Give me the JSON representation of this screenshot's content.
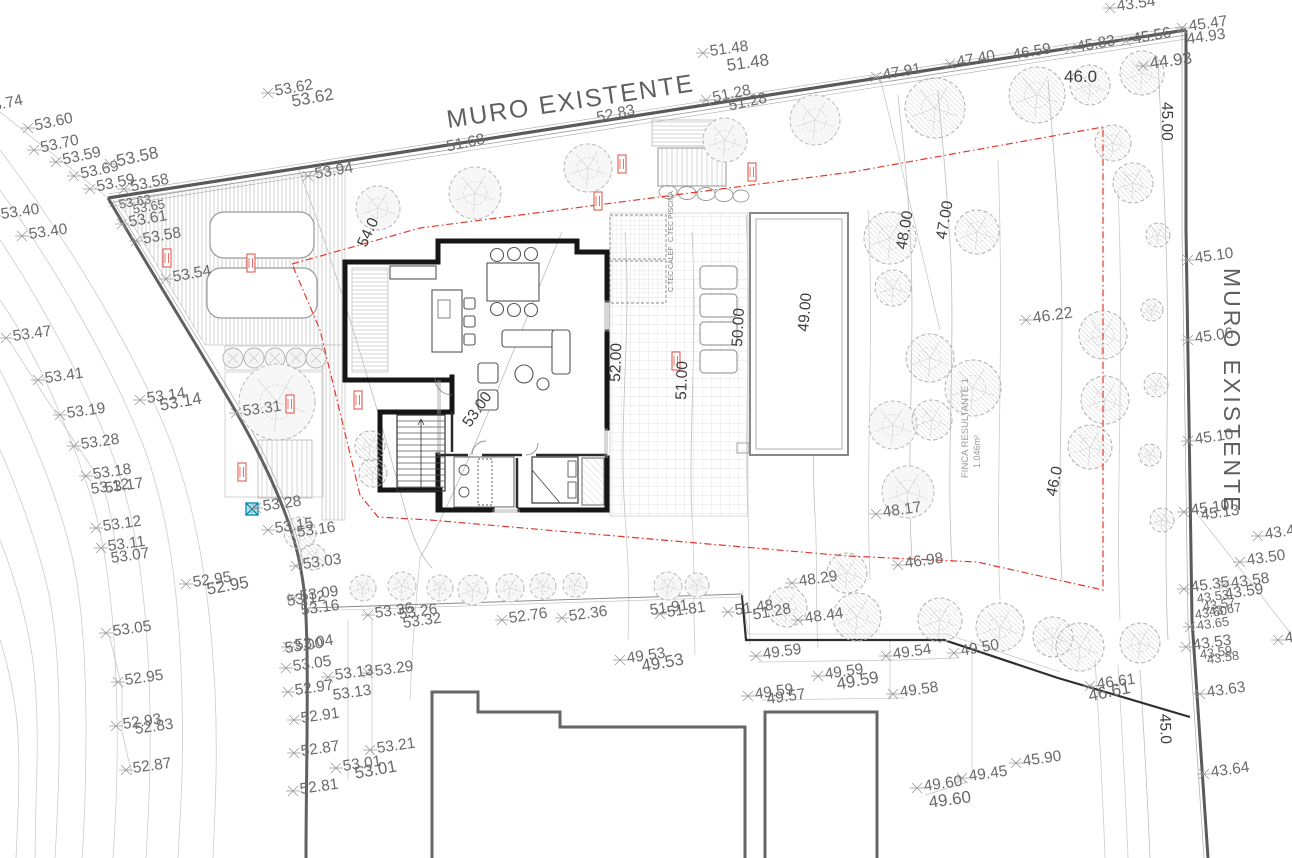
{
  "walls": {
    "top_label": "MURO EXISTENTE",
    "right_label": "MURO EXISTENTE"
  },
  "parcel": {
    "name": "FINCA RESULTANTE 1",
    "area": "1.046m²"
  },
  "rooms": {
    "pool_tech": "C.TEC PISCINA",
    "boiler": "C.TEC CALEF"
  },
  "colors": {
    "boundary_red": "#e0382c",
    "marker_cyan": "#3fb9d9",
    "wall_gray": "#5a5a5a",
    "label_gray": "#6a6a6a",
    "contour_label": "#3d3d3d"
  },
  "spot_elevations": [
    {
      "v": "53.74",
      "x": -22,
      "y": 110,
      "r": -12
    },
    {
      "v": "53.60",
      "x": 28,
      "y": 128,
      "r": -12
    },
    {
      "v": "53.70",
      "x": 34,
      "y": 150,
      "r": -12
    },
    {
      "v": "53.59",
      "x": 56,
      "y": 162,
      "r": -12
    },
    {
      "v": "53.69",
      "x": 74,
      "y": 176,
      "r": -12
    },
    {
      "v": "53.59",
      "x": 90,
      "y": 189,
      "r": -12
    },
    {
      "v": "53.58",
      "x": 110,
      "y": 164,
      "r": -12,
      "s": 17
    },
    {
      "v": "53.58",
      "x": 124,
      "y": 189,
      "r": -12
    },
    {
      "v": "53.40",
      "x": -6,
      "y": 216,
      "r": -8
    },
    {
      "v": "53.40",
      "x": 22,
      "y": 236,
      "r": -8
    },
    {
      "v": "53.63",
      "x": 112,
      "y": 206,
      "r": -10,
      "m": 0,
      "s": 13
    },
    {
      "v": "53.65",
      "x": 126,
      "y": 211,
      "r": -10,
      "m": 0,
      "s": 13
    },
    {
      "v": "53.61",
      "x": 122,
      "y": 224,
      "r": -10
    },
    {
      "v": "53.58",
      "x": 136,
      "y": 241,
      "r": -10
    },
    {
      "v": "53.54",
      "x": 166,
      "y": 279,
      "r": -10
    },
    {
      "v": "53.62",
      "x": 268,
      "y": 93,
      "r": -10
    },
    {
      "v": "53.62",
      "x": 285,
      "y": 104,
      "r": -10,
      "m": 0,
      "s": 17
    },
    {
      "v": "53.94",
      "x": 308,
      "y": 176,
      "r": -10
    },
    {
      "v": "51.48",
      "x": 703,
      "y": 53,
      "r": -8
    },
    {
      "v": "51.48",
      "x": 720,
      "y": 68,
      "r": -8,
      "m": 0,
      "s": 17
    },
    {
      "v": "51.28",
      "x": 706,
      "y": 100,
      "r": -12
    },
    {
      "v": "51.28",
      "x": 722,
      "y": 108,
      "r": -12,
      "m": 0
    },
    {
      "v": "51.68",
      "x": 440,
      "y": 149,
      "r": -12,
      "m": 0
    },
    {
      "v": "52.83",
      "x": 590,
      "y": 120,
      "r": -12,
      "m": 0
    },
    {
      "v": "47.91",
      "x": 876,
      "y": 77,
      "r": -10
    },
    {
      "v": "47.40",
      "x": 950,
      "y": 64,
      "r": -10
    },
    {
      "v": "46.59",
      "x": 1006,
      "y": 57,
      "r": -10,
      "m": 0
    },
    {
      "v": "45.83",
      "x": 1070,
      "y": 49,
      "r": -10
    },
    {
      "v": "45.56",
      "x": 1126,
      "y": 41,
      "r": -10
    },
    {
      "v": "44.93",
      "x": 1143,
      "y": 66,
      "r": -8,
      "s": 17
    },
    {
      "v": "43.54",
      "x": 1110,
      "y": 8,
      "r": -8
    },
    {
      "v": "45.47",
      "x": 1182,
      "y": 28,
      "r": -8
    },
    {
      "v": "44.93",
      "x": 1180,
      "y": 41,
      "r": -8,
      "m": 0
    },
    {
      "v": "45.10",
      "x": 1188,
      "y": 260,
      "r": -8
    },
    {
      "v": "45.06",
      "x": 1188,
      "y": 340,
      "r": -8
    },
    {
      "v": "45.10",
      "x": 1188,
      "y": 441,
      "r": -8
    },
    {
      "v": "45.10",
      "x": 1184,
      "y": 512,
      "r": -8
    },
    {
      "v": "45.13",
      "x": 1194,
      "y": 517,
      "r": -8,
      "m": 0
    },
    {
      "v": "43.47",
      "x": 1258,
      "y": 536,
      "r": -8
    },
    {
      "v": "43.50",
      "x": 1240,
      "y": 562,
      "r": -8
    },
    {
      "v": "43.58",
      "x": 1224,
      "y": 585,
      "r": -8
    },
    {
      "v": "43.59",
      "x": 1218,
      "y": 596,
      "r": -8,
      "m": 0
    },
    {
      "v": "45.35",
      "x": 1184,
      "y": 589,
      "r": -8
    },
    {
      "v": "43.53",
      "x": 1190,
      "y": 600,
      "r": -8,
      "m": 0,
      "s": 13
    },
    {
      "v": "43.57",
      "x": 1196,
      "y": 608,
      "r": -8,
      "m": 0,
      "s": 13
    },
    {
      "v": "43.60",
      "x": 1188,
      "y": 616,
      "r": -8,
      "m": 0,
      "s": 13
    },
    {
      "v": "43.67",
      "x": 1202,
      "y": 613,
      "r": -8,
      "m": 0,
      "s": 13
    },
    {
      "v": "43.65",
      "x": 1190,
      "y": 627,
      "r": -8,
      "s": 13
    },
    {
      "v": "43.53",
      "x": 1186,
      "y": 647,
      "r": -8
    },
    {
      "v": "43.59",
      "x": 1193,
      "y": 656,
      "r": -8,
      "m": 0,
      "s": 13
    },
    {
      "v": "43.58",
      "x": 1200,
      "y": 661,
      "r": -8,
      "m": 0,
      "s": 13
    },
    {
      "v": "43.63",
      "x": 1200,
      "y": 694,
      "r": -8
    },
    {
      "v": "43.64",
      "x": 1204,
      "y": 774,
      "r": -8
    },
    {
      "v": "43.65",
      "x": 1278,
      "y": 640,
      "r": -8
    },
    {
      "v": "46.61",
      "x": 1090,
      "y": 686,
      "r": -8
    },
    {
      "v": "46.61",
      "x": 1082,
      "y": 699,
      "r": -12,
      "m": 0,
      "s": 17
    },
    {
      "v": "45.90",
      "x": 1016,
      "y": 763,
      "r": -8
    },
    {
      "v": "49.45",
      "x": 962,
      "y": 778,
      "r": -8
    },
    {
      "v": "49.60",
      "x": 917,
      "y": 788,
      "r": -8
    },
    {
      "v": "49.60",
      "x": 922,
      "y": 805,
      "r": -8,
      "m": 0,
      "s": 17
    },
    {
      "v": "49.59",
      "x": 756,
      "y": 656,
      "r": -8
    },
    {
      "v": "49.54",
      "x": 886,
      "y": 656,
      "r": -8
    },
    {
      "v": "49.50",
      "x": 954,
      "y": 653,
      "r": -10
    },
    {
      "v": "49.59",
      "x": 818,
      "y": 676,
      "r": -8
    },
    {
      "v": "49.59",
      "x": 830,
      "y": 687,
      "r": -10,
      "m": 0,
      "s": 17
    },
    {
      "v": "49.59",
      "x": 748,
      "y": 696,
      "r": -8
    },
    {
      "v": "49.57",
      "x": 760,
      "y": 701,
      "r": -8,
      "m": 0
    },
    {
      "v": "49.58",
      "x": 893,
      "y": 694,
      "r": -8
    },
    {
      "v": "49.53",
      "x": 620,
      "y": 660,
      "r": -8
    },
    {
      "v": "49.53",
      "x": 635,
      "y": 669,
      "r": -10,
      "m": 0,
      "s": 17
    },
    {
      "v": "48.44",
      "x": 798,
      "y": 620,
      "r": -8
    },
    {
      "v": "51.28",
      "x": 746,
      "y": 617,
      "r": -10,
      "m": 0
    },
    {
      "v": "51.48",
      "x": 728,
      "y": 612,
      "r": -8
    },
    {
      "v": "48.29",
      "x": 792,
      "y": 583,
      "r": -8
    },
    {
      "v": "46.98",
      "x": 898,
      "y": 565,
      "r": -8
    },
    {
      "v": "48.17",
      "x": 876,
      "y": 514,
      "r": -8
    },
    {
      "v": "51.81",
      "x": 660,
      "y": 614,
      "r": -8
    },
    {
      "v": "51.91",
      "x": 643,
      "y": 612,
      "r": -8,
      "m": 0
    },
    {
      "v": "52.36",
      "x": 562,
      "y": 618,
      "r": -8
    },
    {
      "v": "52.76",
      "x": 502,
      "y": 620,
      "r": -8
    },
    {
      "v": "53.36",
      "x": 368,
      "y": 615,
      "r": -8
    },
    {
      "v": "53.26",
      "x": 392,
      "y": 616,
      "r": -8,
      "m": 0
    },
    {
      "v": "53.32",
      "x": 396,
      "y": 625,
      "r": -8,
      "m": 0
    },
    {
      "v": "53.29",
      "x": 368,
      "y": 673,
      "r": -8
    },
    {
      "v": "53.13",
      "x": 328,
      "y": 677,
      "r": -8
    },
    {
      "v": "53.13",
      "x": 326,
      "y": 697,
      "r": -8,
      "m": 0
    },
    {
      "v": "53.21",
      "x": 370,
      "y": 750,
      "r": -8
    },
    {
      "v": "53.01",
      "x": 336,
      "y": 768,
      "r": -8
    },
    {
      "v": "53.01",
      "x": 348,
      "y": 776,
      "r": -10,
      "m": 0,
      "s": 17
    },
    {
      "v": "53.09",
      "x": 293,
      "y": 598,
      "r": -8
    },
    {
      "v": "53.12",
      "x": 280,
      "y": 603,
      "r": -8,
      "m": 0
    },
    {
      "v": "53.16",
      "x": 294,
      "y": 612,
      "r": -8,
      "m": 0
    },
    {
      "v": "53.04",
      "x": 288,
      "y": 647,
      "r": -8
    },
    {
      "v": "53.00",
      "x": 278,
      "y": 650,
      "r": -8,
      "m": 0
    },
    {
      "v": "53.05",
      "x": 286,
      "y": 668,
      "r": -8
    },
    {
      "v": "52.97",
      "x": 288,
      "y": 692,
      "r": -8
    },
    {
      "v": "52.91",
      "x": 294,
      "y": 720,
      "r": -8
    },
    {
      "v": "52.87",
      "x": 294,
      "y": 753,
      "r": -8
    },
    {
      "v": "52.81",
      "x": 293,
      "y": 791,
      "r": -8
    },
    {
      "v": "53.05",
      "x": 106,
      "y": 633,
      "r": -8
    },
    {
      "v": "52.95",
      "x": 118,
      "y": 682,
      "r": -8
    },
    {
      "v": "52.93",
      "x": 116,
      "y": 726,
      "r": -8
    },
    {
      "v": "52.83",
      "x": 128,
      "y": 731,
      "r": -8,
      "m": 0
    },
    {
      "v": "52.87",
      "x": 126,
      "y": 770,
      "r": -8
    },
    {
      "v": "52.95",
      "x": 186,
      "y": 584,
      "r": -8
    },
    {
      "v": "52.95",
      "x": 200,
      "y": 592,
      "r": -10,
      "m": 0,
      "s": 17
    },
    {
      "v": "53.47",
      "x": 6,
      "y": 338,
      "r": -8
    },
    {
      "v": "53.41",
      "x": 38,
      "y": 380,
      "r": -8
    },
    {
      "v": "53.19",
      "x": 60,
      "y": 415,
      "r": -8
    },
    {
      "v": "53.28",
      "x": 74,
      "y": 446,
      "r": -8
    },
    {
      "v": "53.18",
      "x": 86,
      "y": 476,
      "r": -8
    },
    {
      "v": "53.17",
      "x": 98,
      "y": 490,
      "r": -8,
      "m": 0
    },
    {
      "v": "53.12",
      "x": 84,
      "y": 491,
      "r": -8,
      "m": 0
    },
    {
      "v": "53.12",
      "x": 96,
      "y": 528,
      "r": -8
    },
    {
      "v": "53.11",
      "x": 101,
      "y": 548,
      "r": -8
    },
    {
      "v": "53.07",
      "x": 104,
      "y": 560,
      "r": -8,
      "m": 0
    },
    {
      "v": "53.14",
      "x": 140,
      "y": 400,
      "r": -8
    },
    {
      "v": "53.14",
      "x": 153,
      "y": 408,
      "r": -10,
      "m": 0,
      "s": 17
    },
    {
      "v": "53.31",
      "x": 236,
      "y": 413,
      "r": -8
    },
    {
      "v": "53.28",
      "x": 256,
      "y": 508,
      "r": -8
    },
    {
      "v": "53.15",
      "x": 268,
      "y": 530,
      "r": -8
    },
    {
      "v": "53.16",
      "x": 290,
      "y": 534,
      "r": -8,
      "m": 0
    },
    {
      "v": "53.03",
      "x": 296,
      "y": 566,
      "r": -8
    },
    {
      "v": "46.22",
      "x": 1026,
      "y": 320,
      "r": -8,
      "s": 16
    }
  ],
  "contour_labels": [
    {
      "v": "54.0",
      "x": 366,
      "y": 248,
      "r": -65
    },
    {
      "v": "53.00",
      "x": 470,
      "y": 428,
      "r": -55
    },
    {
      "v": "52.00",
      "x": 620,
      "y": 382,
      "r": -88
    },
    {
      "v": "51.00",
      "x": 686,
      "y": 400,
      "r": -88
    },
    {
      "v": "50.00",
      "x": 742,
      "y": 347,
      "r": -87
    },
    {
      "v": "49.00",
      "x": 808,
      "y": 332,
      "r": -85
    },
    {
      "v": "48.00",
      "x": 906,
      "y": 250,
      "r": -80
    },
    {
      "v": "47.00",
      "x": 946,
      "y": 240,
      "r": -80
    },
    {
      "v": "46.0",
      "x": 1056,
      "y": 497,
      "r": -78
    },
    {
      "v": "45.00",
      "x": 1162,
      "y": 102,
      "r": 90
    },
    {
      "v": "45.0",
      "x": 1160,
      "y": 714,
      "r": 88
    },
    {
      "v": "46.0",
      "x": 1064,
      "y": 82,
      "r": 0,
      "s": 17
    }
  ]
}
